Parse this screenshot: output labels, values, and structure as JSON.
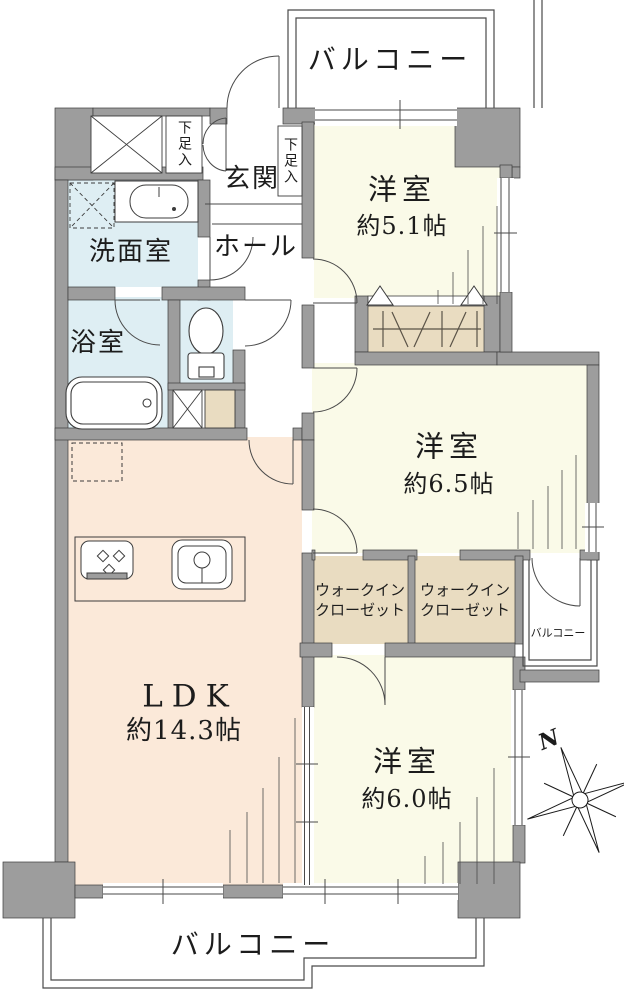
{
  "plan": {
    "balcony_top": {
      "label": "バルコニー"
    },
    "balcony_bottom": {
      "label": "バルコニー"
    },
    "balcony_side": {
      "label": "バルコニー"
    },
    "genkan": {
      "label": "玄関"
    },
    "hall": {
      "label": "ホール"
    },
    "washroom": {
      "label": "洗面室"
    },
    "bathroom": {
      "label": "浴室"
    },
    "shoe_cabinet_left": {
      "label": "下足入"
    },
    "shoe_cabinet_right": {
      "label": "下足入"
    },
    "bedroom1": {
      "label": "洋室",
      "size": "約5.1帖"
    },
    "bedroom2": {
      "label": "洋室",
      "size": "約6.5帖"
    },
    "bedroom3": {
      "label": "洋室",
      "size": "約6.0帖"
    },
    "ldk": {
      "label": "LDK",
      "size": "約14.3帖"
    },
    "wic1": {
      "line1": "ウォークイン",
      "line2": "クローゼット"
    },
    "wic2": {
      "line1": "ウォークイン",
      "line2": "クローゼット"
    },
    "compass": {
      "north": "N"
    },
    "colors": {
      "wall": "#9d9d9d",
      "wall_outline": "#3c3c3c",
      "western_room": "#fafae8",
      "ldk_floor": "#fbe9d9",
      "wet_area": "#deeef3",
      "closet": "#e9dcc1",
      "thin_line": "#4a4a4a"
    }
  }
}
